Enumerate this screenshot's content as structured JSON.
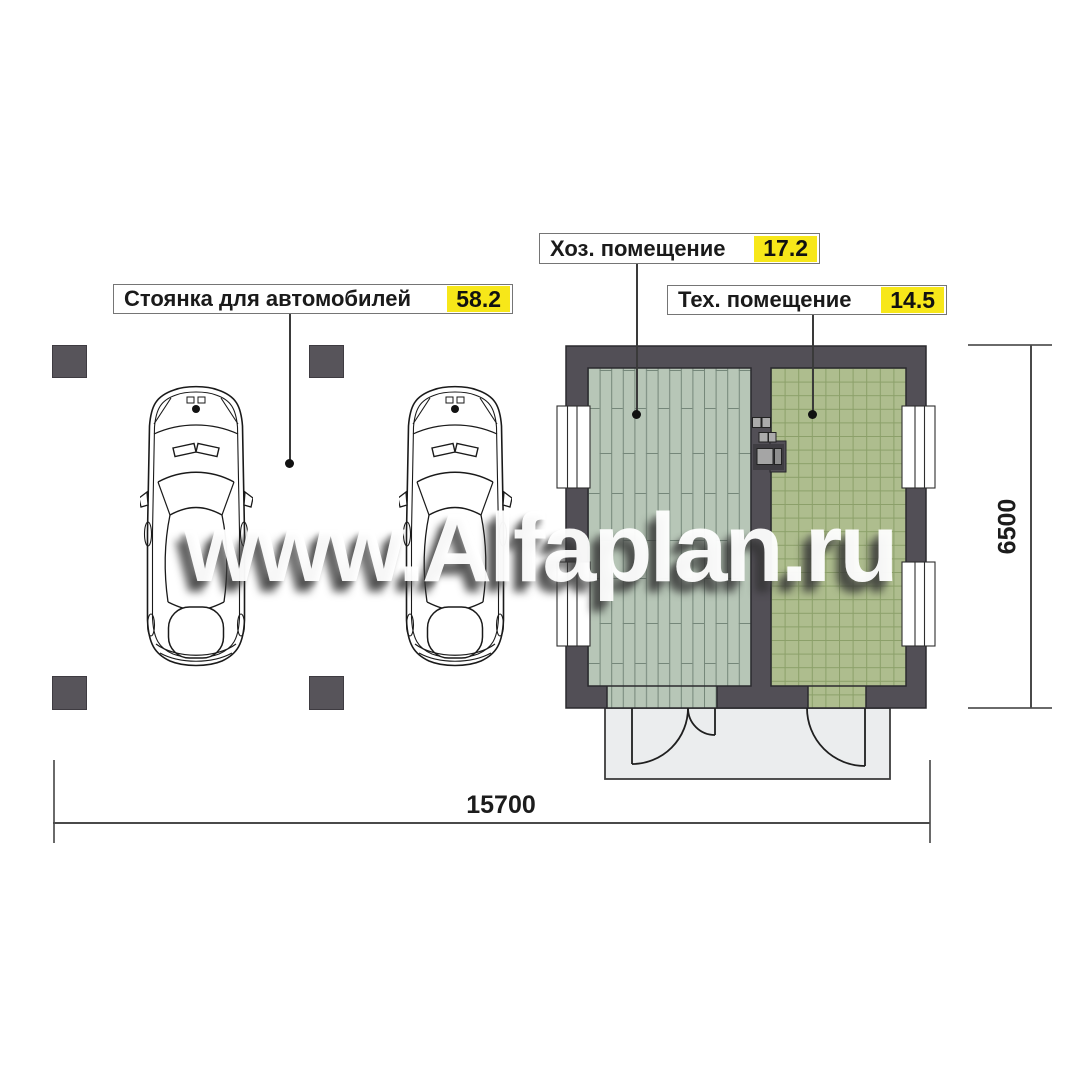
{
  "watermark": {
    "text": "www.Alfaplan.ru"
  },
  "labels": {
    "parking": {
      "text": "Стоянка для автомобилей",
      "area": "58.2"
    },
    "household": {
      "text": "Хоз. помещение",
      "area": "17.2"
    },
    "technical": {
      "text": "Тех. помещение",
      "area": "14.5"
    }
  },
  "dimensions": {
    "overall_width_mm": "15700",
    "overall_depth_mm": "6500"
  },
  "colors": {
    "area_badge": "#f7e719",
    "wall": "#524f56",
    "plank_floor": "#b7c6b7",
    "plank_joint": "#75877a",
    "tile_floor": "#aebd8e",
    "tile_joint": "#8ba069",
    "column": "#57545a",
    "porch": "#ebedee",
    "leader": "#3a3a3a"
  },
  "icons": {
    "cars": "car-top-view-icon",
    "plan": "floor-plan-drawing"
  }
}
